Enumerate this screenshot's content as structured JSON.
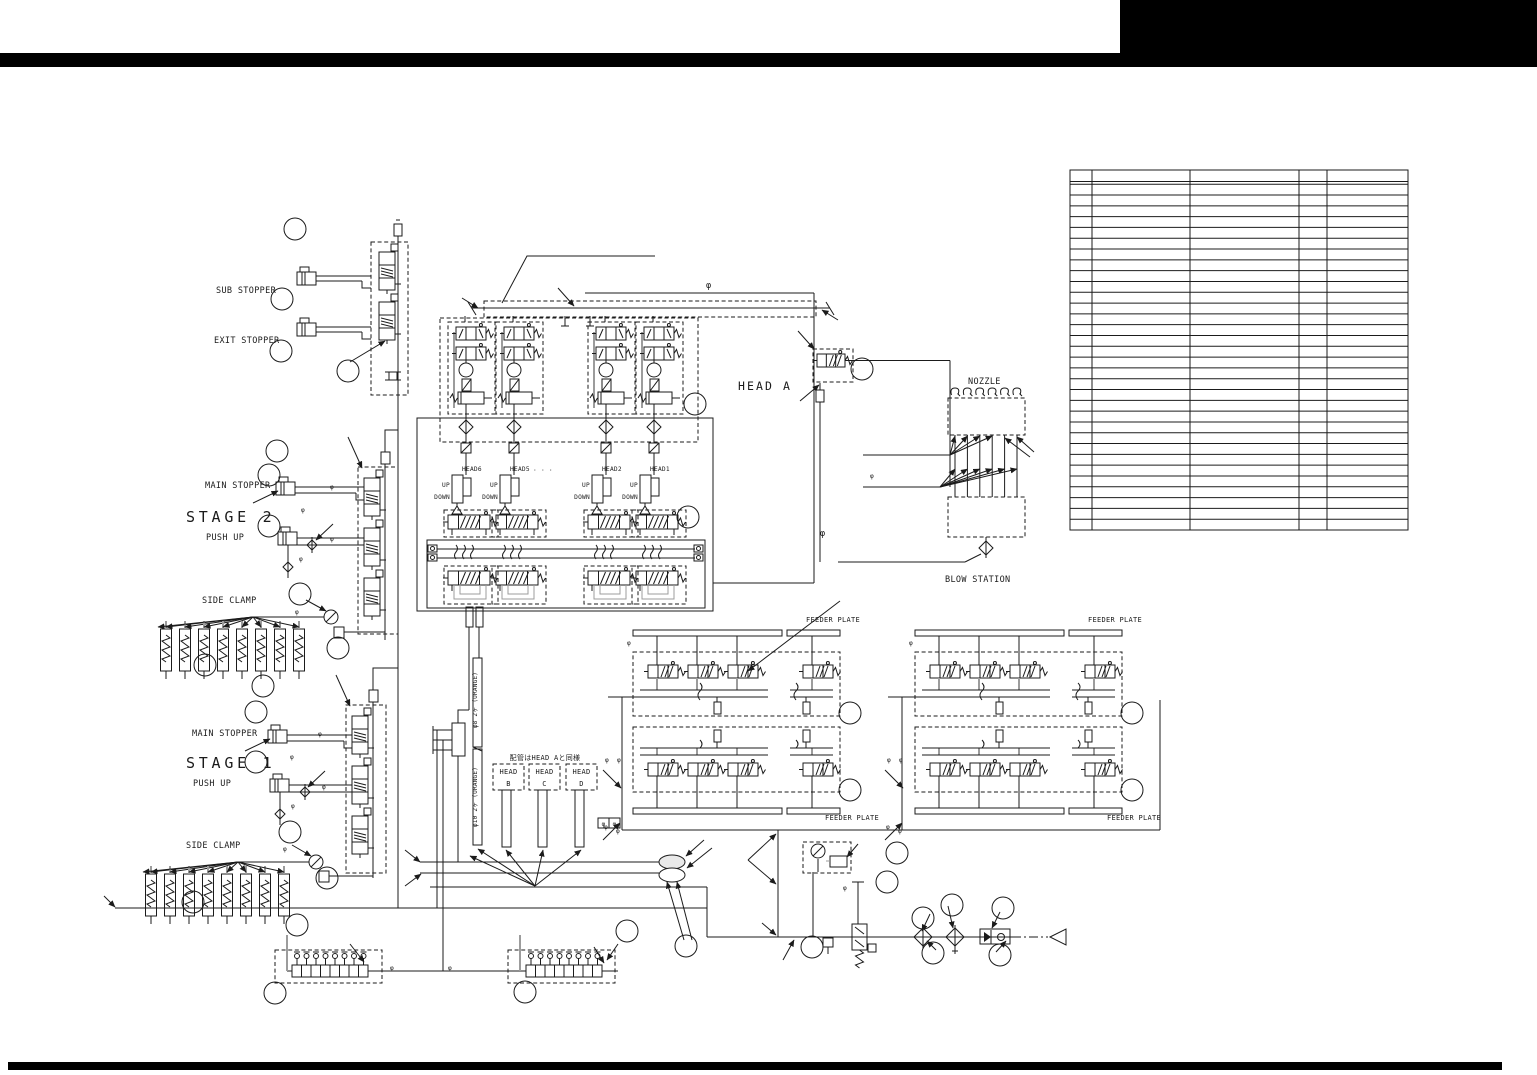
{
  "sheet": {
    "description": "Pneumatic piping schematic sheet with empty parts table",
    "parts_table": {
      "rows": 33,
      "columns": 5,
      "cells_empty": true
    }
  },
  "labels": {
    "sub_stopper": "SUB STOPPER",
    "exit_stopper": "EXIT STOPPER",
    "main_stopper": "MAIN STOPPER",
    "stage2": "STAGE 2",
    "stage1": "STAGE 1",
    "push_up": "PUSH UP",
    "side_clamp": "SIDE CLAMP",
    "head_a": "HEAD A",
    "head6": "HEAD6",
    "head5": "HEAD5",
    "head2": "HEAD2",
    "head1": "HEAD1",
    "up": "UP",
    "down": "DOWN",
    "dots": "· · ·",
    "nozzle": "NOZZLE",
    "blow_station": "BLOW STATION",
    "feeder_plate": "FEEDER PLATE",
    "head": "HEAD",
    "letter_b": "B",
    "letter_c": "C",
    "letter_d": "D",
    "piping_note": "配管はHEAD Aと同様",
    "pipe8": "φ8 2ヶ (ORANGE)",
    "pipe10": "φ10 2ヶ (ORANGE)",
    "phi": "φ"
  }
}
